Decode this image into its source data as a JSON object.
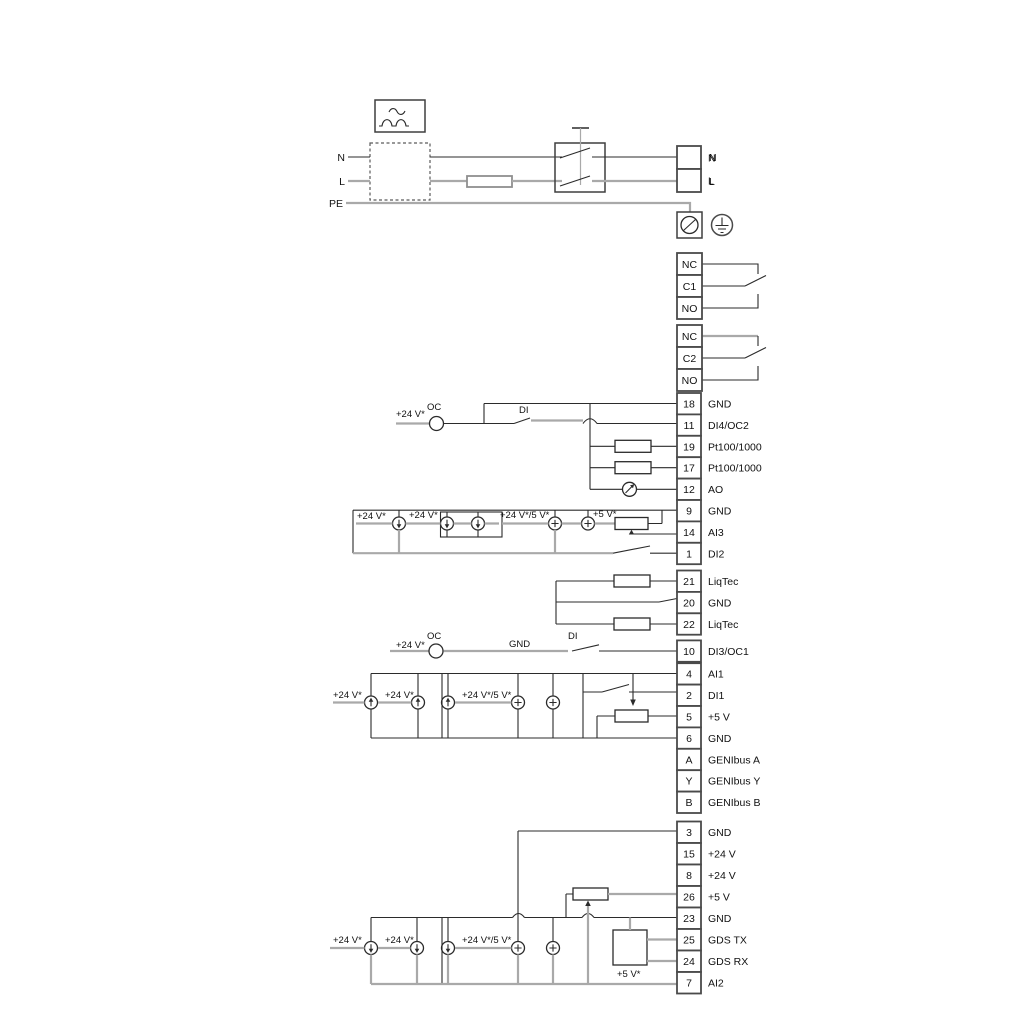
{
  "labels": {
    "v24": "+24 V*",
    "v24or5": "+24 V*/5 V*",
    "v5": "+5 V*",
    "oc": "OC",
    "di": "DI",
    "gnd_wire": "GND"
  },
  "power": {
    "n_in": "N",
    "l_in": "L",
    "pe": "PE",
    "n_out": "N",
    "l_out": "L"
  },
  "blocks": {
    "power_out": [
      {
        "n": "",
        "l": "N"
      },
      {
        "n": "",
        "l": "L"
      }
    ],
    "relay1": [
      {
        "n": "NC",
        "l": ""
      },
      {
        "n": "C1",
        "l": ""
      },
      {
        "n": "NO",
        "l": ""
      }
    ],
    "relay2": [
      {
        "n": "NC",
        "l": ""
      },
      {
        "n": "C2",
        "l": ""
      },
      {
        "n": "NO",
        "l": ""
      }
    ],
    "io_a": [
      {
        "n": "18",
        "l": "GND"
      },
      {
        "n": "11",
        "l": "DI4/OC2"
      },
      {
        "n": "19",
        "l": "Pt100/1000"
      },
      {
        "n": "17",
        "l": "Pt100/1000"
      },
      {
        "n": "12",
        "l": "AO"
      },
      {
        "n": "9",
        "l": "GND"
      },
      {
        "n": "14",
        "l": "AI3"
      },
      {
        "n": "1",
        "l": "DI2"
      }
    ],
    "liqtec": [
      {
        "n": "21",
        "l": "LiqTec"
      },
      {
        "n": "20",
        "l": "GND"
      },
      {
        "n": "22",
        "l": "LiqTec"
      }
    ],
    "di3": [
      {
        "n": "10",
        "l": "DI3/OC1"
      }
    ],
    "io_b": [
      {
        "n": "4",
        "l": "AI1"
      },
      {
        "n": "2",
        "l": "DI1"
      },
      {
        "n": "5",
        "l": "+5 V"
      },
      {
        "n": "6",
        "l": "GND"
      },
      {
        "n": "A",
        "l": "GENIbus A"
      },
      {
        "n": "Y",
        "l": "GENIbus Y"
      },
      {
        "n": "B",
        "l": "GENIbus B"
      }
    ],
    "bottom": [
      {
        "n": "3",
        "l": "GND"
      },
      {
        "n": "15",
        "l": "+24 V"
      },
      {
        "n": "8",
        "l": "+24 V"
      },
      {
        "n": "26",
        "l": "+5 V"
      },
      {
        "n": "23",
        "l": "GND"
      },
      {
        "n": "25",
        "l": "GDS TX"
      },
      {
        "n": "24",
        "l": "GDS RX"
      },
      {
        "n": "7",
        "l": "AI2"
      }
    ]
  }
}
